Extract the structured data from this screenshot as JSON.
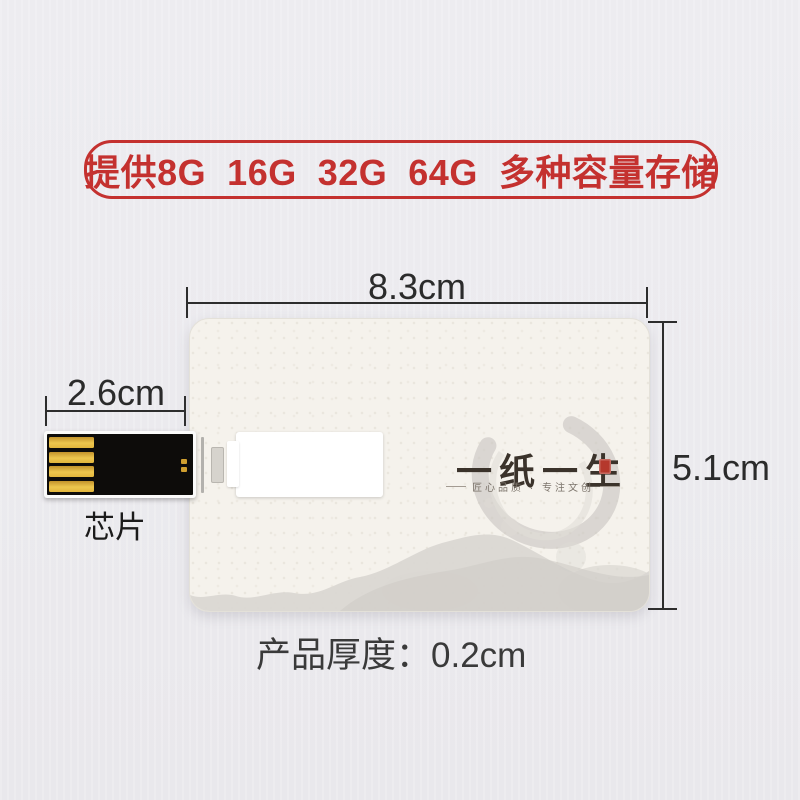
{
  "banner": {
    "text": "提供8G  16G  32G  64G  多种容量存储",
    "color": "#c4312f"
  },
  "dimensions": {
    "card_width": "8.3cm",
    "card_height": "5.1cm",
    "chip_width": "2.6cm",
    "thickness_label": "产品厚度：",
    "thickness_value": "0.2cm"
  },
  "chip": {
    "label": "芯片"
  },
  "card_logo": {
    "title": "一纸一生",
    "subtitle": "匠心品质 · 专注文创"
  },
  "colors": {
    "accent_red": "#c4312f",
    "seal_red": "#b5382c",
    "chip_gold": "#e9c04a",
    "chip_body_black": "#0d0c0a",
    "card_background": "#f5f2ec",
    "page_background": "#ecebef",
    "dimension_line": "#2d2d2d"
  }
}
